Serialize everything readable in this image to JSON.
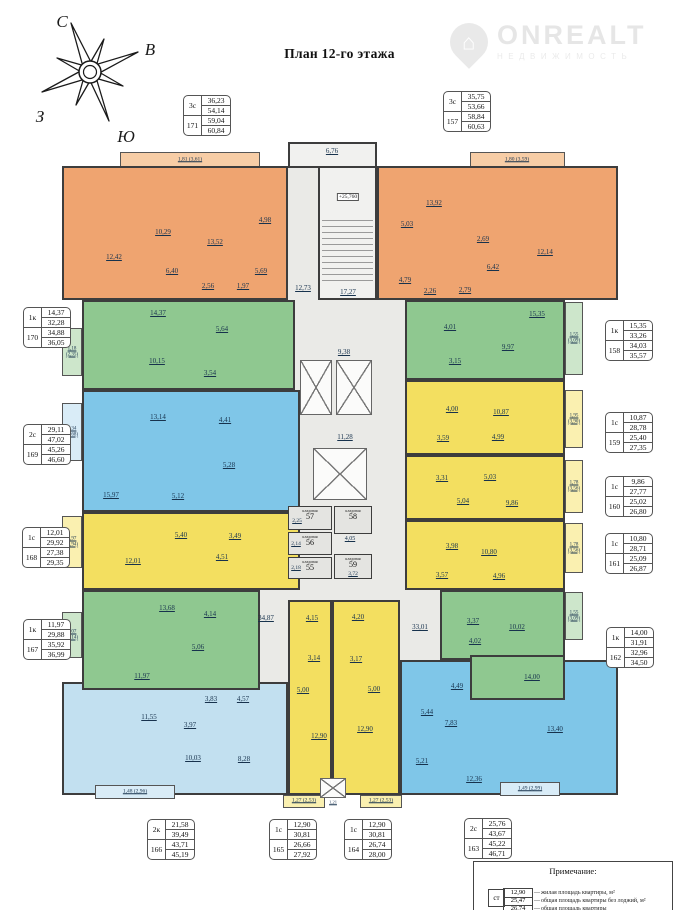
{
  "page": {
    "title": "План 12-го этажа"
  },
  "compass": {
    "n": "С",
    "e": "В",
    "w": "З",
    "s": "Ю"
  },
  "watermark": {
    "brand": "ONREALT",
    "subtitle": "НЕДВИЖИМОСТЬ",
    "house_glyph": "⌂"
  },
  "colors": {
    "orange": "#EFA470",
    "green": "#8FC890",
    "blue": "#7FC6E8",
    "lightblue": "#C2E0F0",
    "yellow": "#F3DF60",
    "paleorange": "#F7CDA6",
    "palegreen": "#CDE6CB",
    "paleblue": "#D9ECF7",
    "paleyellow": "#FAF0B0",
    "coregray": "#EAEAE7",
    "wall": "#3D3D3D"
  },
  "apartment_tables": [
    {
      "type": "3с",
      "number": "171",
      "values": [
        "36,23",
        "54,14",
        "59,04",
        "60,84"
      ]
    },
    {
      "type": "3с",
      "number": "157",
      "values": [
        "35,75",
        "53,66",
        "58,84",
        "60,63"
      ]
    },
    {
      "type": "1к",
      "number": "170",
      "values": [
        "14,37",
        "32,28",
        "34,88",
        "36,05"
      ]
    },
    {
      "type": "2с",
      "number": "169",
      "values": [
        "29,11",
        "47,02",
        "45,26",
        "46,60"
      ]
    },
    {
      "type": "1с",
      "number": "168",
      "values": [
        "12,01",
        "29,92",
        "27,38",
        "29,35"
      ]
    },
    {
      "type": "1к",
      "number": "167",
      "values": [
        "11,97",
        "29,88",
        "35,92",
        "36,99"
      ]
    },
    {
      "type": "1к",
      "number": "158",
      "values": [
        "15,35",
        "33,26",
        "34,03",
        "35,57"
      ]
    },
    {
      "type": "1с",
      "number": "159",
      "values": [
        "10,87",
        "28,78",
        "25,40",
        "27,35"
      ]
    },
    {
      "type": "1с",
      "number": "160",
      "values": [
        "9,86",
        "27,77",
        "25,02",
        "26,80"
      ]
    },
    {
      "type": "1с",
      "number": "161",
      "values": [
        "10,80",
        "28,71",
        "25,09",
        "26,87"
      ]
    },
    {
      "type": "1к",
      "number": "162",
      "values": [
        "14,00",
        "31,91",
        "32,96",
        "34,50"
      ]
    },
    {
      "type": "2к",
      "number": "166",
      "values": [
        "21,58",
        "39,49",
        "43,71",
        "45,19"
      ]
    },
    {
      "type": "1с",
      "number": "165",
      "values": [
        "12,90",
        "30,81",
        "26,66",
        "27,92"
      ]
    },
    {
      "type": "1с",
      "number": "164",
      "values": [
        "12,90",
        "30,81",
        "26,74",
        "28,00"
      ]
    },
    {
      "type": "2с",
      "number": "163",
      "values": [
        "25,76",
        "43,67",
        "45,22",
        "46,71"
      ]
    }
  ],
  "plan": {
    "units": {
      "171": {
        "rooms": [
          "1,81 (3,61)",
          "10,29",
          "13,52",
          "12,42",
          "6,40",
          "4,98",
          "2,56",
          "1,97",
          "5,69"
        ]
      },
      "157": {
        "rooms": [
          "1,80 (3,59)",
          "13,92",
          "5,03",
          "12,14",
          "6,42",
          "2,69",
          "4,79",
          "2,26",
          "2,79"
        ]
      },
      "170": {
        "rooms": [
          "1,18 (2,35)",
          "14,37",
          "10,15",
          "5,64",
          "3,54"
        ]
      },
      "158": {
        "rooms": [
          "1,55 (3,09)",
          "15,35",
          "9,97",
          "4,01",
          "3,15"
        ]
      },
      "169": {
        "rooms": [
          "1,34 (2,68)",
          "13,14",
          "4,41",
          "15,97",
          "5,12",
          "5,28"
        ]
      },
      "159": {
        "rooms": [
          "1,95 (3,90)",
          "10,87",
          "4,99",
          "4,00",
          "3,59"
        ]
      },
      "160": {
        "rooms": [
          "1,78 (3,56)",
          "9,86",
          "5,03",
          "3,31",
          "5,04"
        ]
      },
      "168": {
        "rooms": [
          "1,97 (3,94)",
          "12,01",
          "5,40",
          "4,51",
          "3,49"
        ]
      },
      "161": {
        "rooms": [
          "1,78 (3,56)",
          "10,80",
          "4,96",
          "3,98",
          "3,57"
        ]
      },
      "167": {
        "rooms": [
          "1,07 (2,14)",
          "13,68",
          "4,14",
          "5,06",
          "11,97"
        ]
      },
      "162": {
        "rooms": [
          "1,55 (3,09)",
          "14,00",
          "10,02",
          "4,02",
          "3,37"
        ]
      },
      "166": {
        "rooms": [
          "1,48 (2,96)",
          "11,55",
          "3,97",
          "10,03",
          "8,28",
          "3,83",
          "4,57"
        ]
      },
      "165": {
        "rooms": [
          "1,27 (2,53)",
          "12,90",
          "5,00",
          "4,15",
          "3,14"
        ]
      },
      "164": {
        "rooms": [
          "1,27 (2,53)",
          "12,90",
          "5,00",
          "4,20",
          "3,17"
        ]
      },
      "163": {
        "rooms": [
          "1,49 (2,99)",
          "13,40",
          "12,36",
          "7,83",
          "5,44",
          "5,21",
          "4,49"
        ]
      }
    },
    "core": {
      "entrance_area": "6,76",
      "stair_elevation": "+25,760",
      "stairwell_area": "17,27",
      "corridor_top": "12,73",
      "lift_lobby": "9,38",
      "corridor_mid": "11,28",
      "corridor_left": "34,87",
      "corridor_right": "33,01",
      "storage_corridor": "4,05",
      "duct": "1,21",
      "storage_word": "кладовая",
      "storages": [
        {
          "num": "57",
          "area": "2,25"
        },
        {
          "num": "58",
          "area": ""
        },
        {
          "num": "56",
          "area": "2,14"
        },
        {
          "num": "55",
          "area": "2,18"
        },
        {
          "num": "59",
          "area": "3,72"
        }
      ]
    }
  },
  "note": {
    "title": "Примечание:",
    "sample_type": "ст",
    "arrow": "—",
    "rows": [
      {
        "value": "12,90",
        "label": "жилая площадь квартиры, м²"
      },
      {
        "value": "25,47",
        "label": "общая площадь квартиры без лоджий, м²"
      },
      {
        "value": "26,74",
        "label": "общая площадь квартиры"
      }
    ]
  }
}
